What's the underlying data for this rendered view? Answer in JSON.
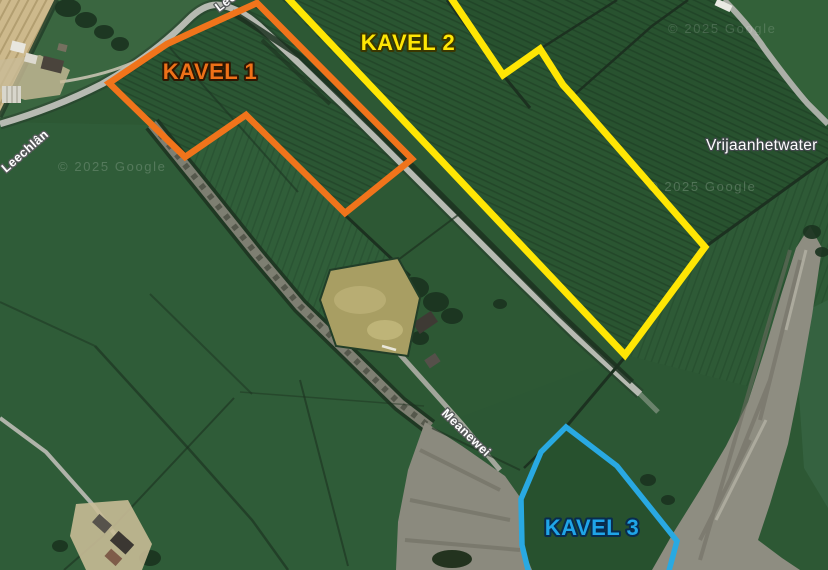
{
  "map": {
    "watermark_text": "© 2025 Google",
    "road_labels": [
      {
        "id": "leechlan-main",
        "text": "Leechlân"
      },
      {
        "id": "leechlan-top-clipped",
        "text": "Leechlân"
      },
      {
        "id": "meanewei",
        "text": "Meanewei"
      }
    ],
    "place_labels": [
      {
        "id": "vrijaanhetwater",
        "text": "Vrijaanhetwater"
      }
    ],
    "parcels": [
      {
        "id": "kavel-1",
        "label": "KAVEL 1",
        "stroke_color": "#F0741B",
        "label_color": "#EE7118",
        "label_outline": "#2E1803",
        "points": "257,3 412,159 345,213 246,115 185,157 109,83 167,44 193,32"
      },
      {
        "id": "kavel-2",
        "label": "KAVEL 2",
        "stroke_color": "#FFE604",
        "label_color": "#FFE604",
        "label_outline": "#3A3700",
        "points": "282,-8 447,-8 503,75 540,49 563,85 573,96 705,247 625,355"
      },
      {
        "id": "kavel-3",
        "label": "KAVEL 3",
        "stroke_color": "#29A9E2",
        "label_color": "#1FA5E8",
        "label_outline": "#092C4E",
        "points": "566,427 617,466 677,541 667,578 530,578 522,545 521,499 541,452"
      }
    ]
  }
}
